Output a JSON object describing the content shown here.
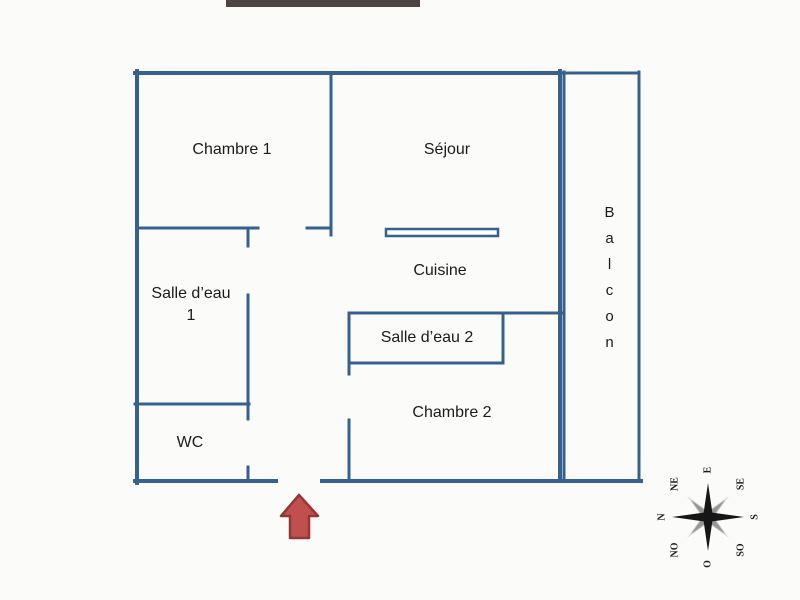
{
  "plan": {
    "rooms": {
      "chambre1": {
        "label": "Chambre 1"
      },
      "sejour": {
        "label": "Séjour"
      },
      "cuisine": {
        "label": "Cuisine"
      },
      "salle_eau_1": {
        "label": "Salle d’eau 1"
      },
      "salle_eau_2": {
        "label": "Salle d’eau 2"
      },
      "chambre2": {
        "label": "Chambre 2"
      },
      "wc": {
        "label": "WC"
      },
      "balcon": {
        "label": "Balcon"
      }
    },
    "entrance_arrow": {
      "direction": "up"
    }
  },
  "compass": {
    "points": [
      "N",
      "NE",
      "E",
      "SE",
      "S",
      "SO",
      "O",
      "NO"
    ]
  },
  "colors": {
    "wall": "#36618E",
    "top_bar": "#4E4343",
    "arrow_fill": "#C0504D",
    "arrow_stroke": "#943634",
    "text": "#1B1B1B"
  }
}
